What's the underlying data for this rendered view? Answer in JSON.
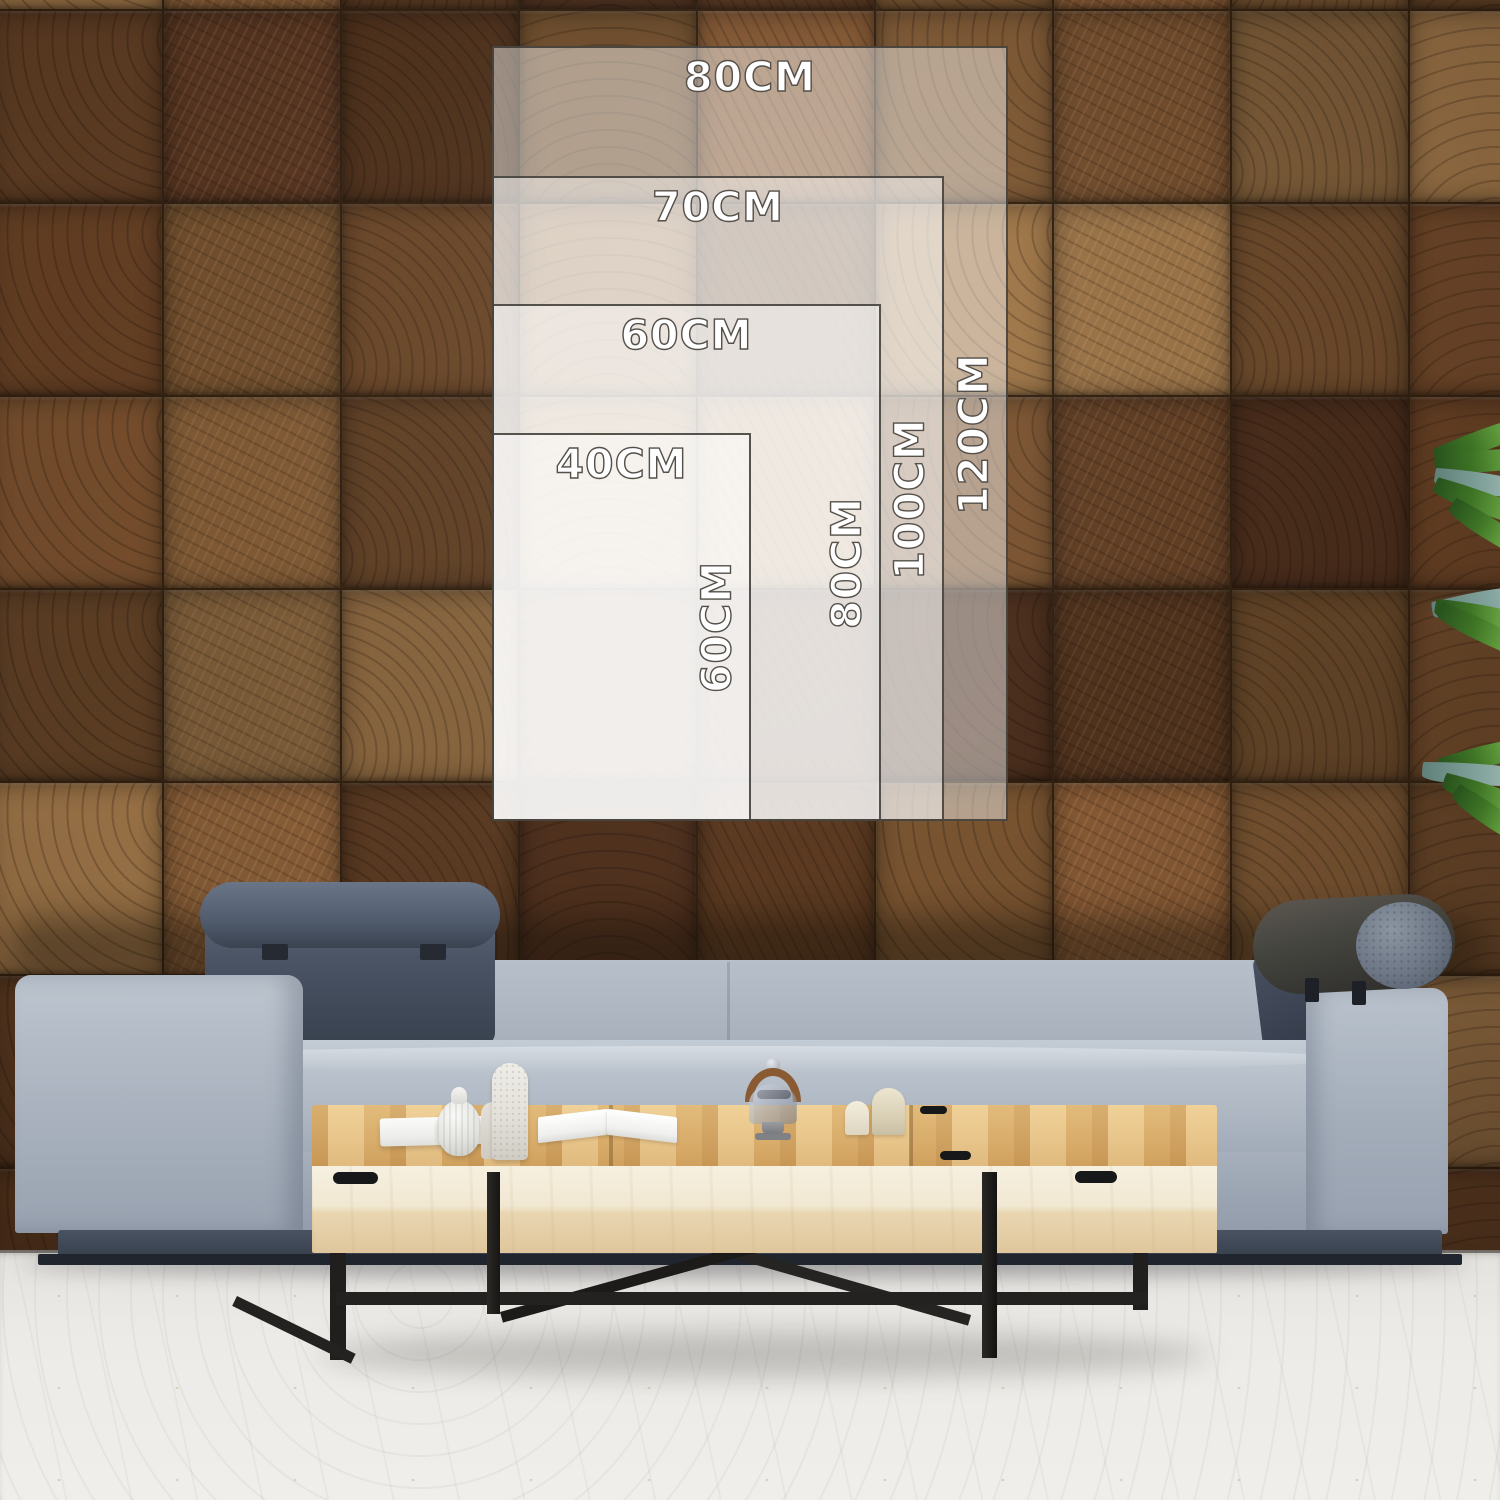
{
  "size_guide": {
    "unit": "CM",
    "sizes": [
      {
        "name": "80x120",
        "width_label": "80CM",
        "height_label": "120CM",
        "width_cm": 80,
        "height_cm": 120
      },
      {
        "name": "70x100",
        "width_label": "70CM",
        "height_label": "100CM",
        "width_cm": 70,
        "height_cm": 100
      },
      {
        "name": "60x80",
        "width_label": "60CM",
        "height_label": "80CM",
        "width_cm": 60,
        "height_cm": 80
      },
      {
        "name": "40x60",
        "width_label": "40CM",
        "height_label": "60CM",
        "width_cm": 40,
        "height_cm": 60
      }
    ],
    "overlay_fill": "rgba(255,255,255,0.45)",
    "overlay_border": "#3a3630",
    "label_color": "#ffffff",
    "label_outline": "#55504a"
  },
  "scene": {
    "wall": "end-grain-wood-tile-wall",
    "floor": "white-concrete-floor",
    "sofa": "light-gray-fabric-sofa",
    "headrest_left": "quilted-dark-gray-headrest",
    "headrest_right": "dark-bolster-headrest",
    "cushion_right": "quilted-dark-cushion",
    "table": "light-wood-coffee-table-black-metal-frame",
    "plant": "green-plant-right-edge",
    "decor": [
      "white-book-stack",
      "ribbed-gourd-vase",
      "tall-stone-vase",
      "short-stone-vase",
      "open-book",
      "glass-cloche-wood-handle",
      "cream-candle-small",
      "cream-candle-large"
    ]
  },
  "colors": {
    "wall_brown_dark": "#5c3a21",
    "wall_brown_mid": "#7c5532",
    "wall_brown_light": "#9b7347",
    "sofa_fabric": "#aab3bd",
    "headrest_dark": "#46505f",
    "plinth": "#3e4754",
    "table_top": "#ddb272",
    "table_front": "#f1e8d2",
    "metal_leg": "#211f1d",
    "floor": "#edebe7",
    "plant_green": "#67a341"
  }
}
